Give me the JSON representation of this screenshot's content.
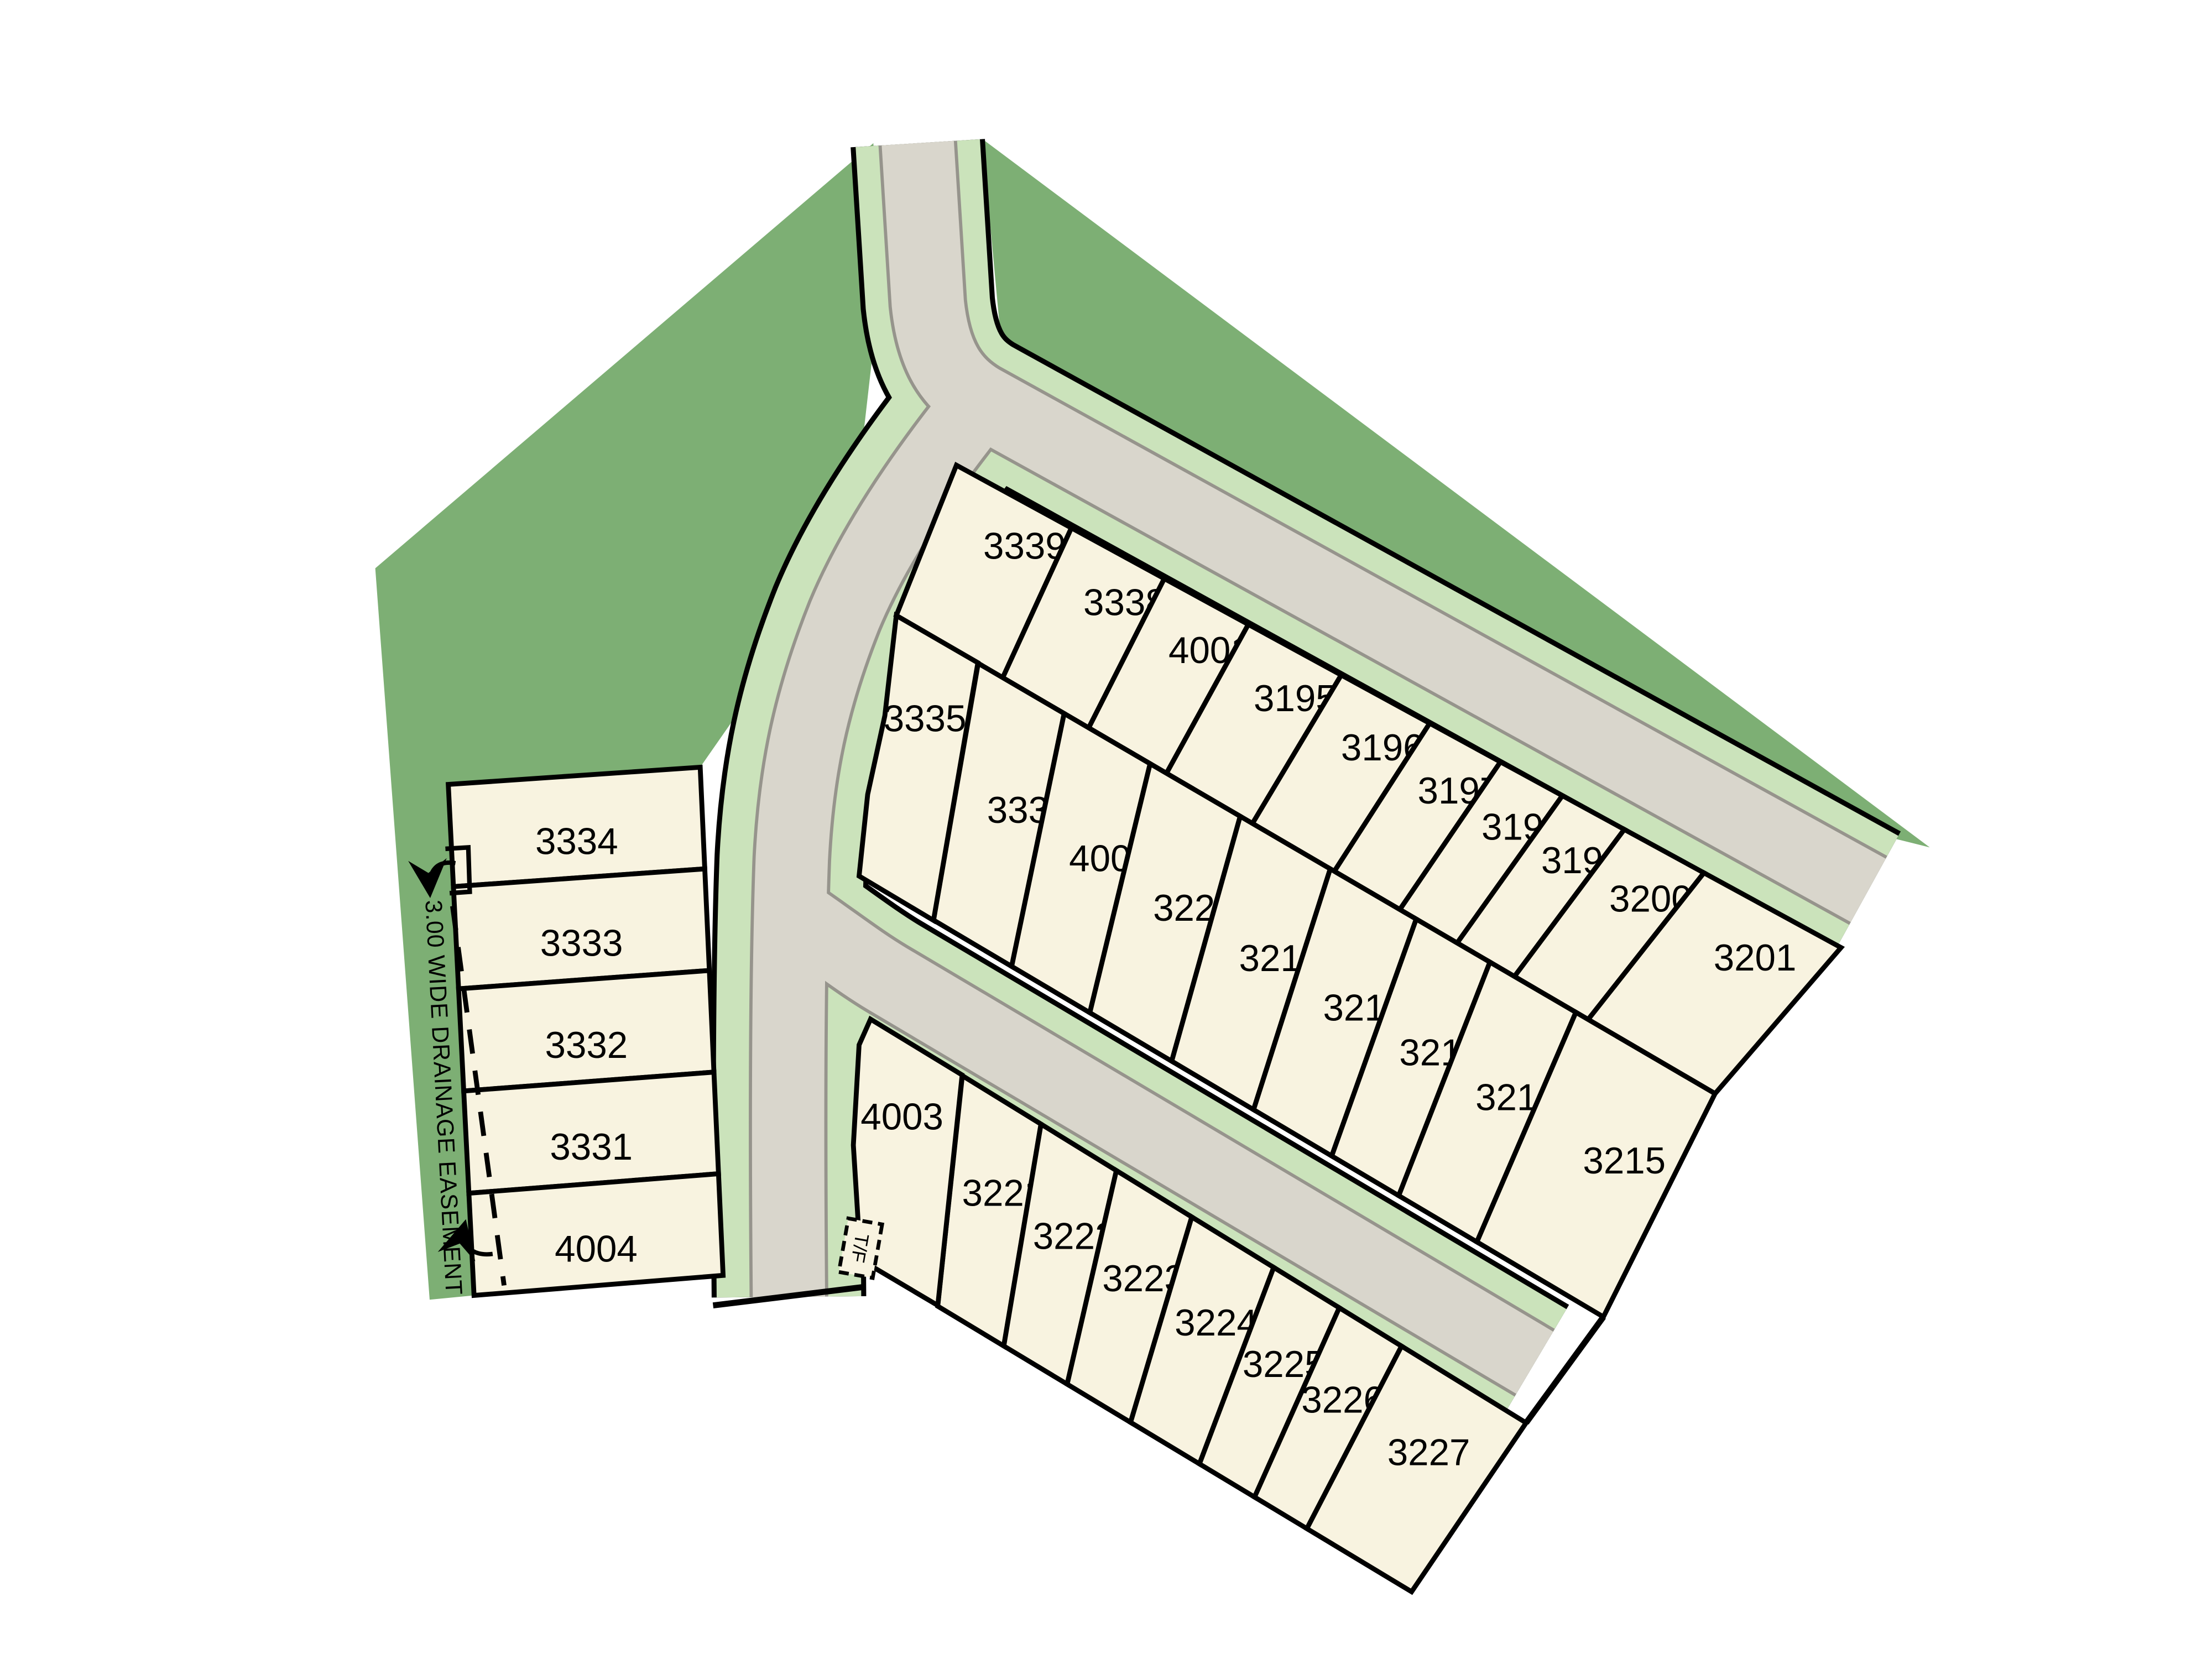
{
  "map": {
    "labels": {
      "drainage_easement": "3.00 WIDE DRAINAGE EASEMENT",
      "truncation_marker": "T/F"
    },
    "colors": {
      "site_green": "#7daf74",
      "verge_green": "#cbe3bb",
      "road_gray": "#d9d6cc",
      "road_edge_gray": "#96948c",
      "parcel_cream": "#f8f3e0",
      "line_black": "#000000"
    },
    "lot_groups": [
      {
        "name": "west-column",
        "lots": [
          "3334",
          "3333",
          "3332",
          "3331",
          "4004"
        ]
      },
      {
        "name": "north-row",
        "lots": [
          "3339",
          "3338",
          "4001",
          "3195",
          "3196",
          "3197",
          "3198",
          "3199",
          "3200",
          "3201"
        ]
      },
      {
        "name": "middle-row",
        "lots": [
          "3335",
          "3336",
          "4002",
          "3220",
          "3219",
          "3218",
          "3217",
          "3216",
          "3215"
        ]
      },
      {
        "name": "south-row",
        "lots": [
          "4003",
          "3221",
          "3222",
          "3223",
          "3224",
          "3225",
          "3226",
          "3227"
        ]
      }
    ]
  }
}
